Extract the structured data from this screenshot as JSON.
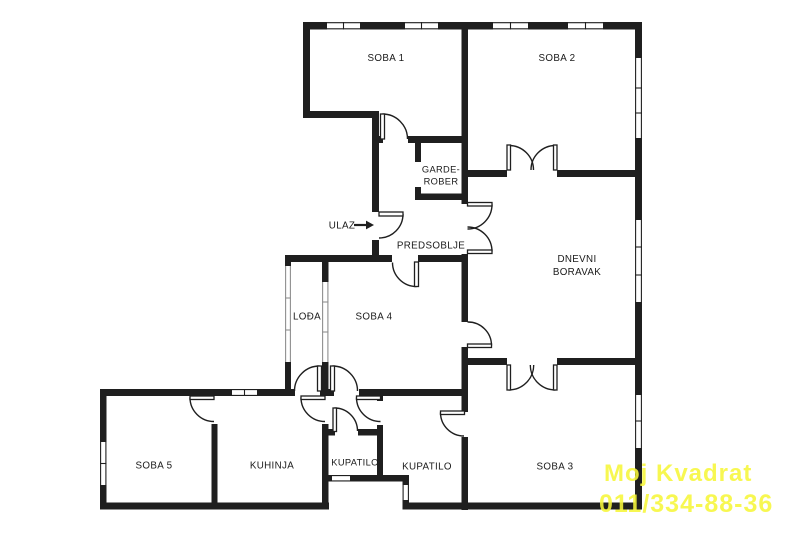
{
  "rooms": {
    "soba1": {
      "label": "SOBA 1"
    },
    "soba2": {
      "label": "SOBA 2"
    },
    "soba3": {
      "label": "SOBA 3"
    },
    "soba4": {
      "label": "SOBA 4"
    },
    "soba5": {
      "label": "SOBA 5"
    },
    "kuhinja": {
      "label": "KUHINJA"
    },
    "kupatilo_small": {
      "label": "KUPATILO"
    },
    "kupatilo_large": {
      "label": "KUPATILO"
    },
    "loggia": {
      "label": "LOĐA"
    },
    "predsoblje": {
      "label": "PREDSOBLJE"
    },
    "garderober": {
      "line1": "GARDE-",
      "line2": "ROBER"
    },
    "dnevni_boravak": {
      "line1": "DNEVNI",
      "line2": "BORAVAK"
    }
  },
  "entrance": {
    "label": "ULAZ"
  },
  "watermark": {
    "line1": "Moj Kvadrat",
    "line2": "011/334-88-36",
    "color": "#f7f73a"
  },
  "colors": {
    "wall": "#1f1f1f",
    "background": "#ffffff",
    "text": "#1a1a1a"
  }
}
